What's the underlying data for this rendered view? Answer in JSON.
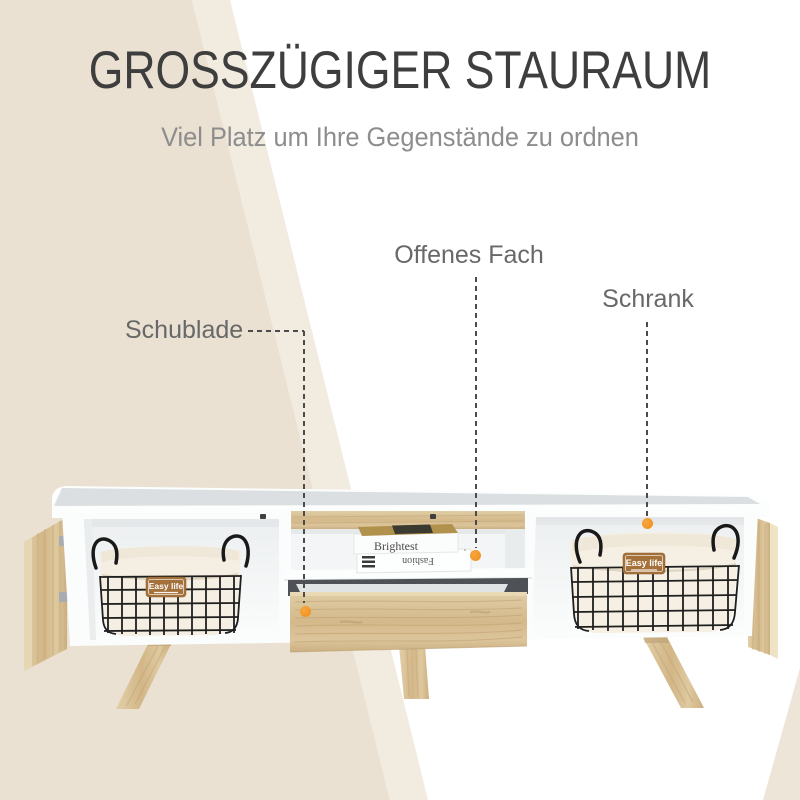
{
  "page": {
    "title": "GROSSZÜGIGER STAURAUM",
    "subtitle": "Viel Platz um Ihre Gegenstände zu ordnen"
  },
  "callouts": {
    "drawer": "Schublade",
    "open_shelf": "Offenes Fach",
    "cabinet": "Schrank"
  },
  "furniture": {
    "basket_tag": "Easy life",
    "book_top": "Brightest",
    "book_bottom": "Fashion"
  },
  "colors": {
    "accent_orange": "#EF8E17",
    "dash_gray": "#4B4B4B",
    "title_gray": "#3E3E3E",
    "subtitle_gray": "#8D8D8D",
    "label_gray": "#686868",
    "background_beige": "#EAE1D2",
    "background_beige_light": "#F2EBDF",
    "wood": "#D6BC90",
    "furniture_white": "#FCFDFD"
  }
}
